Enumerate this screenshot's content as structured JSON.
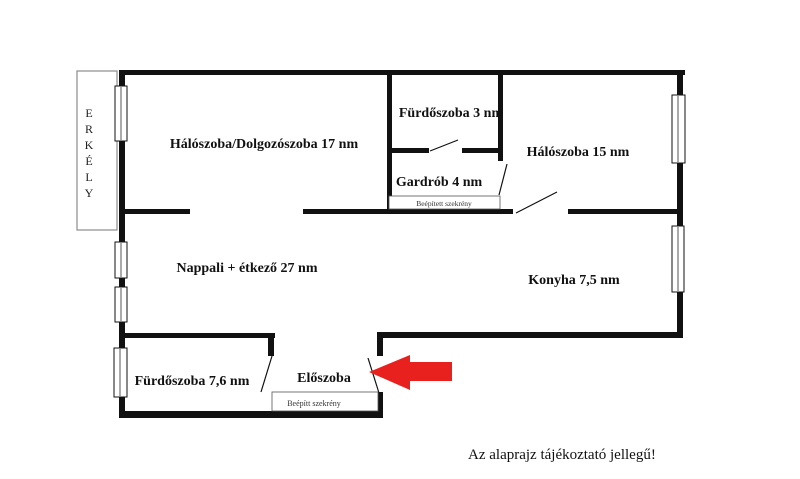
{
  "note": "Az alaprajz tájékoztató jellegű!",
  "balcony": {
    "label": "ERKÉLY",
    "letters": [
      "E",
      "R",
      "K",
      "É",
      "L",
      "Y"
    ]
  },
  "rooms": {
    "bedroom_office": {
      "label": "Hálószoba/Dolgozószoba 17 nm"
    },
    "bathroom_small": {
      "label": "Fürdőszoba 3 nm"
    },
    "wardrobe": {
      "label": "Gardrób 4 nm"
    },
    "bedroom": {
      "label": "Hálószoba 15 nm"
    },
    "living_dining": {
      "label": "Nappali + étkező 27 nm"
    },
    "kitchen": {
      "label": "Konyha 7,5 nm"
    },
    "bathroom_large": {
      "label": "Fürdőszoba 7,6 nm"
    },
    "hallway": {
      "label": "Előszoba"
    }
  },
  "closets": {
    "wardrobe_builtin": "Beépített szekrény",
    "hallway_builtin": "Beépítt szekrény"
  },
  "colors": {
    "wall": "#111111",
    "arrow": "#e8201e",
    "balcony_border": "#8c8c8c"
  }
}
